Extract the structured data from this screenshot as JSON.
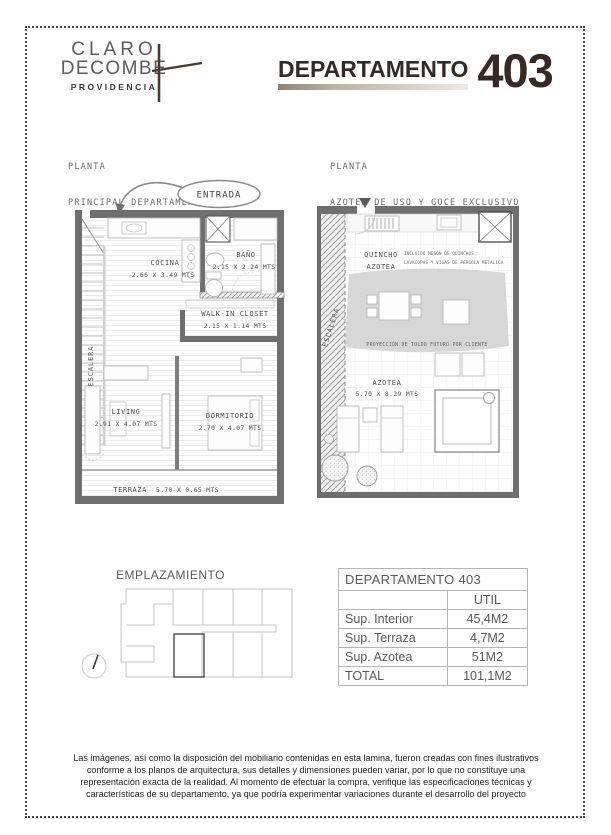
{
  "logo": {
    "line1": "CLARO",
    "line2": "DECOMBE",
    "sub": "PROVIDENCIA"
  },
  "header": {
    "title_label": "DEPARTAMENTO",
    "unit_number": "403"
  },
  "sections": {
    "left_heading_line1": "PLANTA",
    "left_heading_line2": "PRINCIPAL DEPARTAMENTO",
    "right_heading_line1": "PLANTA",
    "right_heading_line2": "AZOTEA DE USO Y GOCE EXCLUSIVO"
  },
  "entrada_label": "ENTRADA",
  "left_plan": {
    "escalera": "ESCALERA",
    "cocina": {
      "name": "COCINA",
      "dims": "2.66 X 3.49 MTS"
    },
    "bano": {
      "name": "BAÑO",
      "dims": "2.15 X 2.24 MTS"
    },
    "walkin": {
      "name": "WALK-IN CLOSET",
      "dims": "2.15 X 1.14 MTS"
    },
    "living": {
      "name": "LIVING",
      "dims": "2.91 X 4.07 MTS"
    },
    "dormitorio": {
      "name": "DORMITORIO",
      "dims": "2.70 X 4.07 MTS"
    },
    "terraza": {
      "name": "TERRAZA",
      "dims": "5.70 X 0.65 MTS"
    }
  },
  "right_plan": {
    "escalera": "ESCALERA",
    "quincho_line1": "QUINCHO",
    "quincho_line2": "AZOTEA",
    "note_line1": "INCLUIDO MESÓN DE QUINCHOS,",
    "note_line2": "LAVACOPAS Y VIGAS DE PERGOLA METALICA",
    "toldo_note": "PROYECCIÓN DE TOLDO FUTURO POR CLIENTE",
    "azotea": {
      "name": "AZOTEA",
      "dims": "5.70 X 8.29 MTS"
    }
  },
  "emplazamiento": {
    "heading": "EMPLAZAMIENTO"
  },
  "table": {
    "title": "DEPARTAMENTO  403",
    "col_header": "UTIL",
    "rows": [
      {
        "label": "Sup. Interior",
        "value": "45,4M2"
      },
      {
        "label": "Sup. Terraza",
        "value": "4,7M2"
      },
      {
        "label": "Sup. Azotea",
        "value": "51M2"
      },
      {
        "label": "TOTAL",
        "value": "101,1M2"
      }
    ]
  },
  "footer": {
    "disclaimer": "Las imágenes, así como la disposición del mobiliario contenidas en esta lamina, fueron creadas con fines ilustrativos conforme a los planos de arquitectura, sus detalles y dimensiones pueden variar, por lo que no constituye una representación exacta de la realidad.  Al momento de efectuar la compra, verifique las especificaciones técnicas y características de su departamento, ya que podría experimentar variaciones durante el desarrollo del proyecto"
  },
  "colors": {
    "brand_dark": "#362823",
    "logo_gray": "#5B5C5E",
    "heading_gray": "#6B6B6B",
    "wall_gray": "#6F6F6F",
    "toldo_gray": "#D2D2D2",
    "table_text": "#595959",
    "underline_gradient_start": "#8F8376",
    "underline_gradient_end": "#EFEBE4"
  }
}
